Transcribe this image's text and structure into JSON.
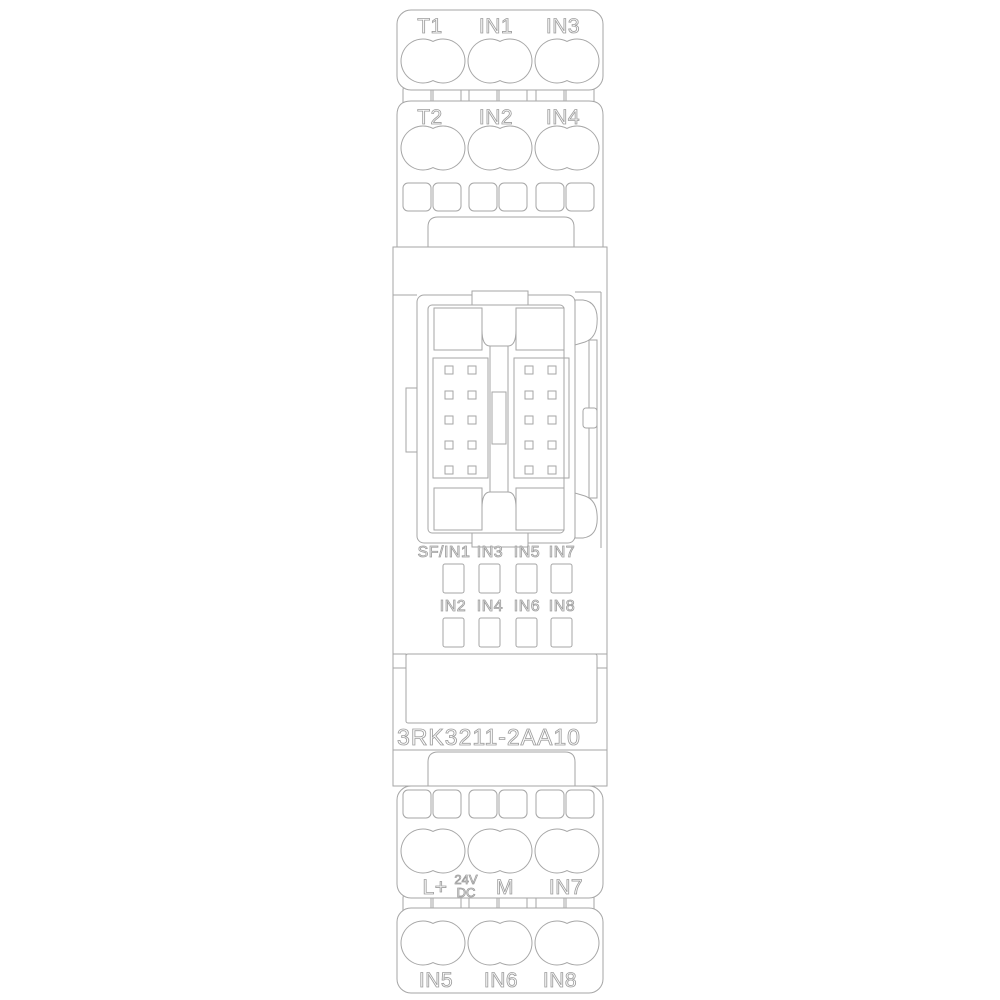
{
  "drawing": {
    "product_number": "3RK3211-2AA10",
    "top_terminals_row1": [
      "T1",
      "IN1",
      "IN3"
    ],
    "top_terminals_row2": [
      "T2",
      "IN2",
      "IN4"
    ],
    "led_row1": [
      "SF/IN1",
      "IN3",
      "IN5",
      "IN7"
    ],
    "led_row2": [
      "IN2",
      "IN4",
      "IN6",
      "IN8"
    ],
    "bottom_terminals_row1": [
      "L+",
      "24V",
      "DC",
      "M",
      "IN7"
    ],
    "bottom_terminals_row2": [
      "IN5",
      "IN6",
      "IN8"
    ]
  },
  "colors": {
    "line": "#a6a6a6",
    "text_outline": "#9e9e9e",
    "background": "#ffffff"
  }
}
